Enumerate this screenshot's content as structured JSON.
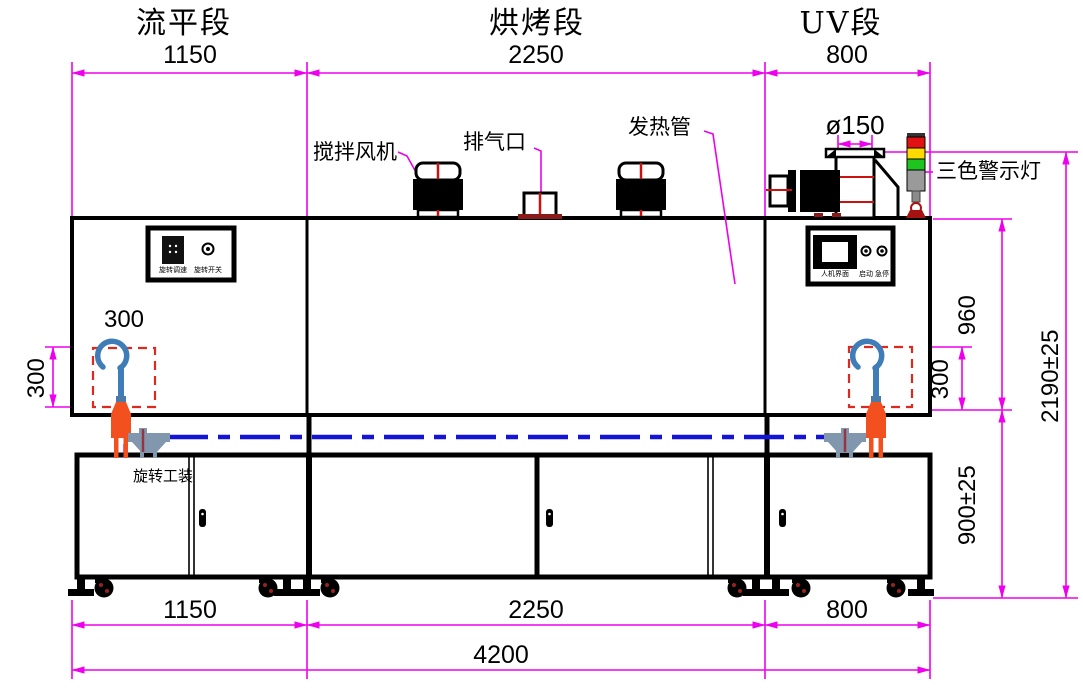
{
  "drawing": {
    "sections": [
      {
        "title": "流平段",
        "length": "1150"
      },
      {
        "title": "烘烤段",
        "length": "2250"
      },
      {
        "title": "UV段",
        "length": "800"
      }
    ],
    "component_labels": {
      "stir_fan": "搅拌风机",
      "exhaust_port": "排气口",
      "heating_tube": "发热管",
      "duct_diameter": "ø150",
      "tricolor_light": "三色警示灯",
      "rotary_fixture": "旋转工装"
    },
    "control_panel_left": {
      "speed": "旋转调速",
      "switch": "旋转开关"
    },
    "control_panel_right": {
      "hmi": "人机界面",
      "start": "启动",
      "estop": "急停"
    },
    "dimensions": {
      "bottom": [
        "1150",
        "2250",
        "800"
      ],
      "total_length": "4200",
      "upper_height": "960",
      "lower_height": "900±25",
      "total_height": "2190±25",
      "fixture_width": "300",
      "fixture_height_left": "300",
      "fixture_height_right": "300"
    },
    "colors": {
      "dimension": "#ee00ee",
      "conveyor_line": "#1414d8",
      "fixture_spindle": "#f2511f",
      "hook": "#3f7db8",
      "dashed_zone": "#e0291e",
      "light_red": "#e31212",
      "light_yellow": "#ffd900",
      "light_green": "#1fc51f"
    }
  }
}
